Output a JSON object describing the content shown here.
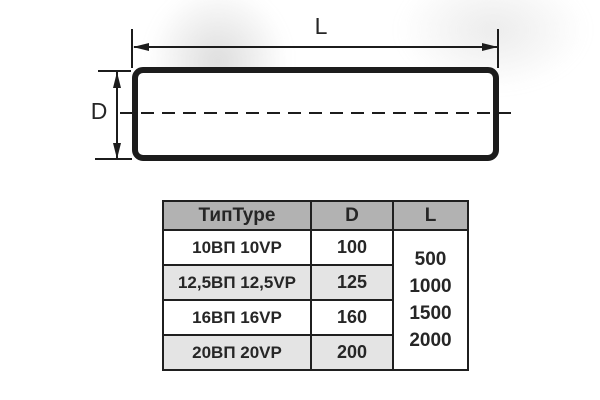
{
  "diagram": {
    "length_label": "L",
    "diameter_label": "D"
  },
  "table": {
    "headers": {
      "type": "ТипType",
      "d": "D",
      "l": "L"
    },
    "rows": [
      {
        "type": "10ВП 10VP",
        "d": "100"
      },
      {
        "type": "12,5ВП 12,5VP",
        "d": "125"
      },
      {
        "type": "16ВП 16VP",
        "d": "160"
      },
      {
        "type": "20ВП 20VP",
        "d": "200"
      }
    ],
    "l_values": [
      "500",
      "1000",
      "1500",
      "2000"
    ]
  },
  "colors": {
    "line_color": "#1c1c1c",
    "text_color": "#262626",
    "table_border": "#1f1f1f",
    "table_header_bg": "#b2b2b2",
    "table_row_alt_bg": "#e4e4e4"
  }
}
